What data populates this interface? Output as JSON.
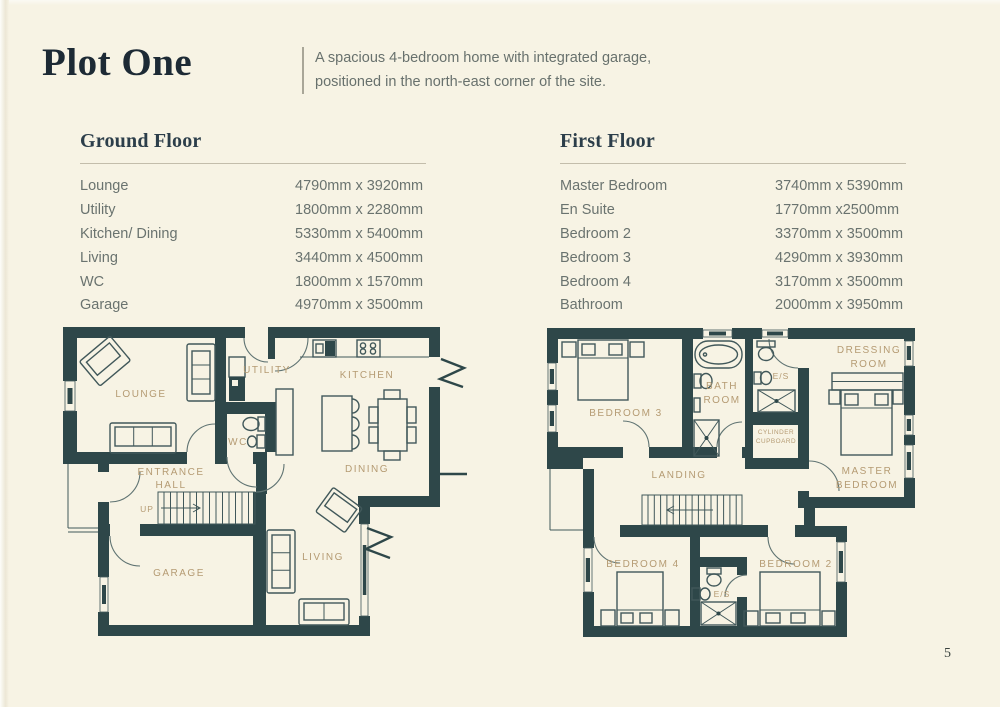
{
  "page": {
    "title": "Plot One",
    "description": [
      "A spacious 4-bedroom home with integrated garage,",
      "positioned in the north-east corner of the site."
    ],
    "page_number": "5"
  },
  "colors": {
    "background": "#f7f3e4",
    "wall": "#2e4749",
    "plan_label": "#b59b73",
    "heading": "#2c3e4a",
    "title": "#1d2a35",
    "body_text": "#6a736f",
    "rule": "#c3bdab"
  },
  "ground_floor": {
    "heading": "Ground Floor",
    "rooms": [
      {
        "name": "Lounge",
        "dims": "4790mm x 3920mm"
      },
      {
        "name": "Utility",
        "dims": "1800mm x 2280mm"
      },
      {
        "name": "Kitchen/ Dining",
        "dims": "5330mm x 5400mm"
      },
      {
        "name": "Living",
        "dims": "3440mm x 4500mm"
      },
      {
        "name": "WC",
        "dims": "1800mm x 1570mm"
      },
      {
        "name": "Garage",
        "dims": "4970mm x 3500mm"
      }
    ],
    "plan": {
      "lounge": "LOUNGE",
      "utility": "UTILITY",
      "kitchen": "KITCHEN",
      "wc": "WC",
      "entrance_1": "ENTRANCE",
      "entrance_2": "HALL",
      "dining": "DINING",
      "up": "UP",
      "garage": "GARAGE",
      "living": "LIVING"
    }
  },
  "first_floor": {
    "heading": "First Floor",
    "rooms": [
      {
        "name": "Master Bedroom",
        "dims": "3740mm x 5390mm"
      },
      {
        "name": "En Suite",
        "dims": "1770mm x2500mm"
      },
      {
        "name": "Bedroom 2",
        "dims": "3370mm x 3500mm"
      },
      {
        "name": "Bedroom 3",
        "dims": "4290mm x 3930mm"
      },
      {
        "name": "Bedroom 4",
        "dims": "3170mm x 3500mm"
      },
      {
        "name": "Bathroom",
        "dims": "2000mm x 3950mm"
      }
    ],
    "plan": {
      "bedroom3": "BEDROOM 3",
      "bath_1": "BATH",
      "bath_2": "ROOM",
      "es_top": "E/S",
      "dressing_1": "DRESSING",
      "dressing_2": "ROOM",
      "cylinder_1": "CYLINDER",
      "cylinder_2": "CUPBOARD",
      "landing": "LANDING",
      "master_1": "MASTER",
      "master_2": "BEDROOM",
      "bedroom4": "BEDROOM 4",
      "es_bottom": "E/S",
      "bedroom2": "BEDROOM 2"
    }
  }
}
